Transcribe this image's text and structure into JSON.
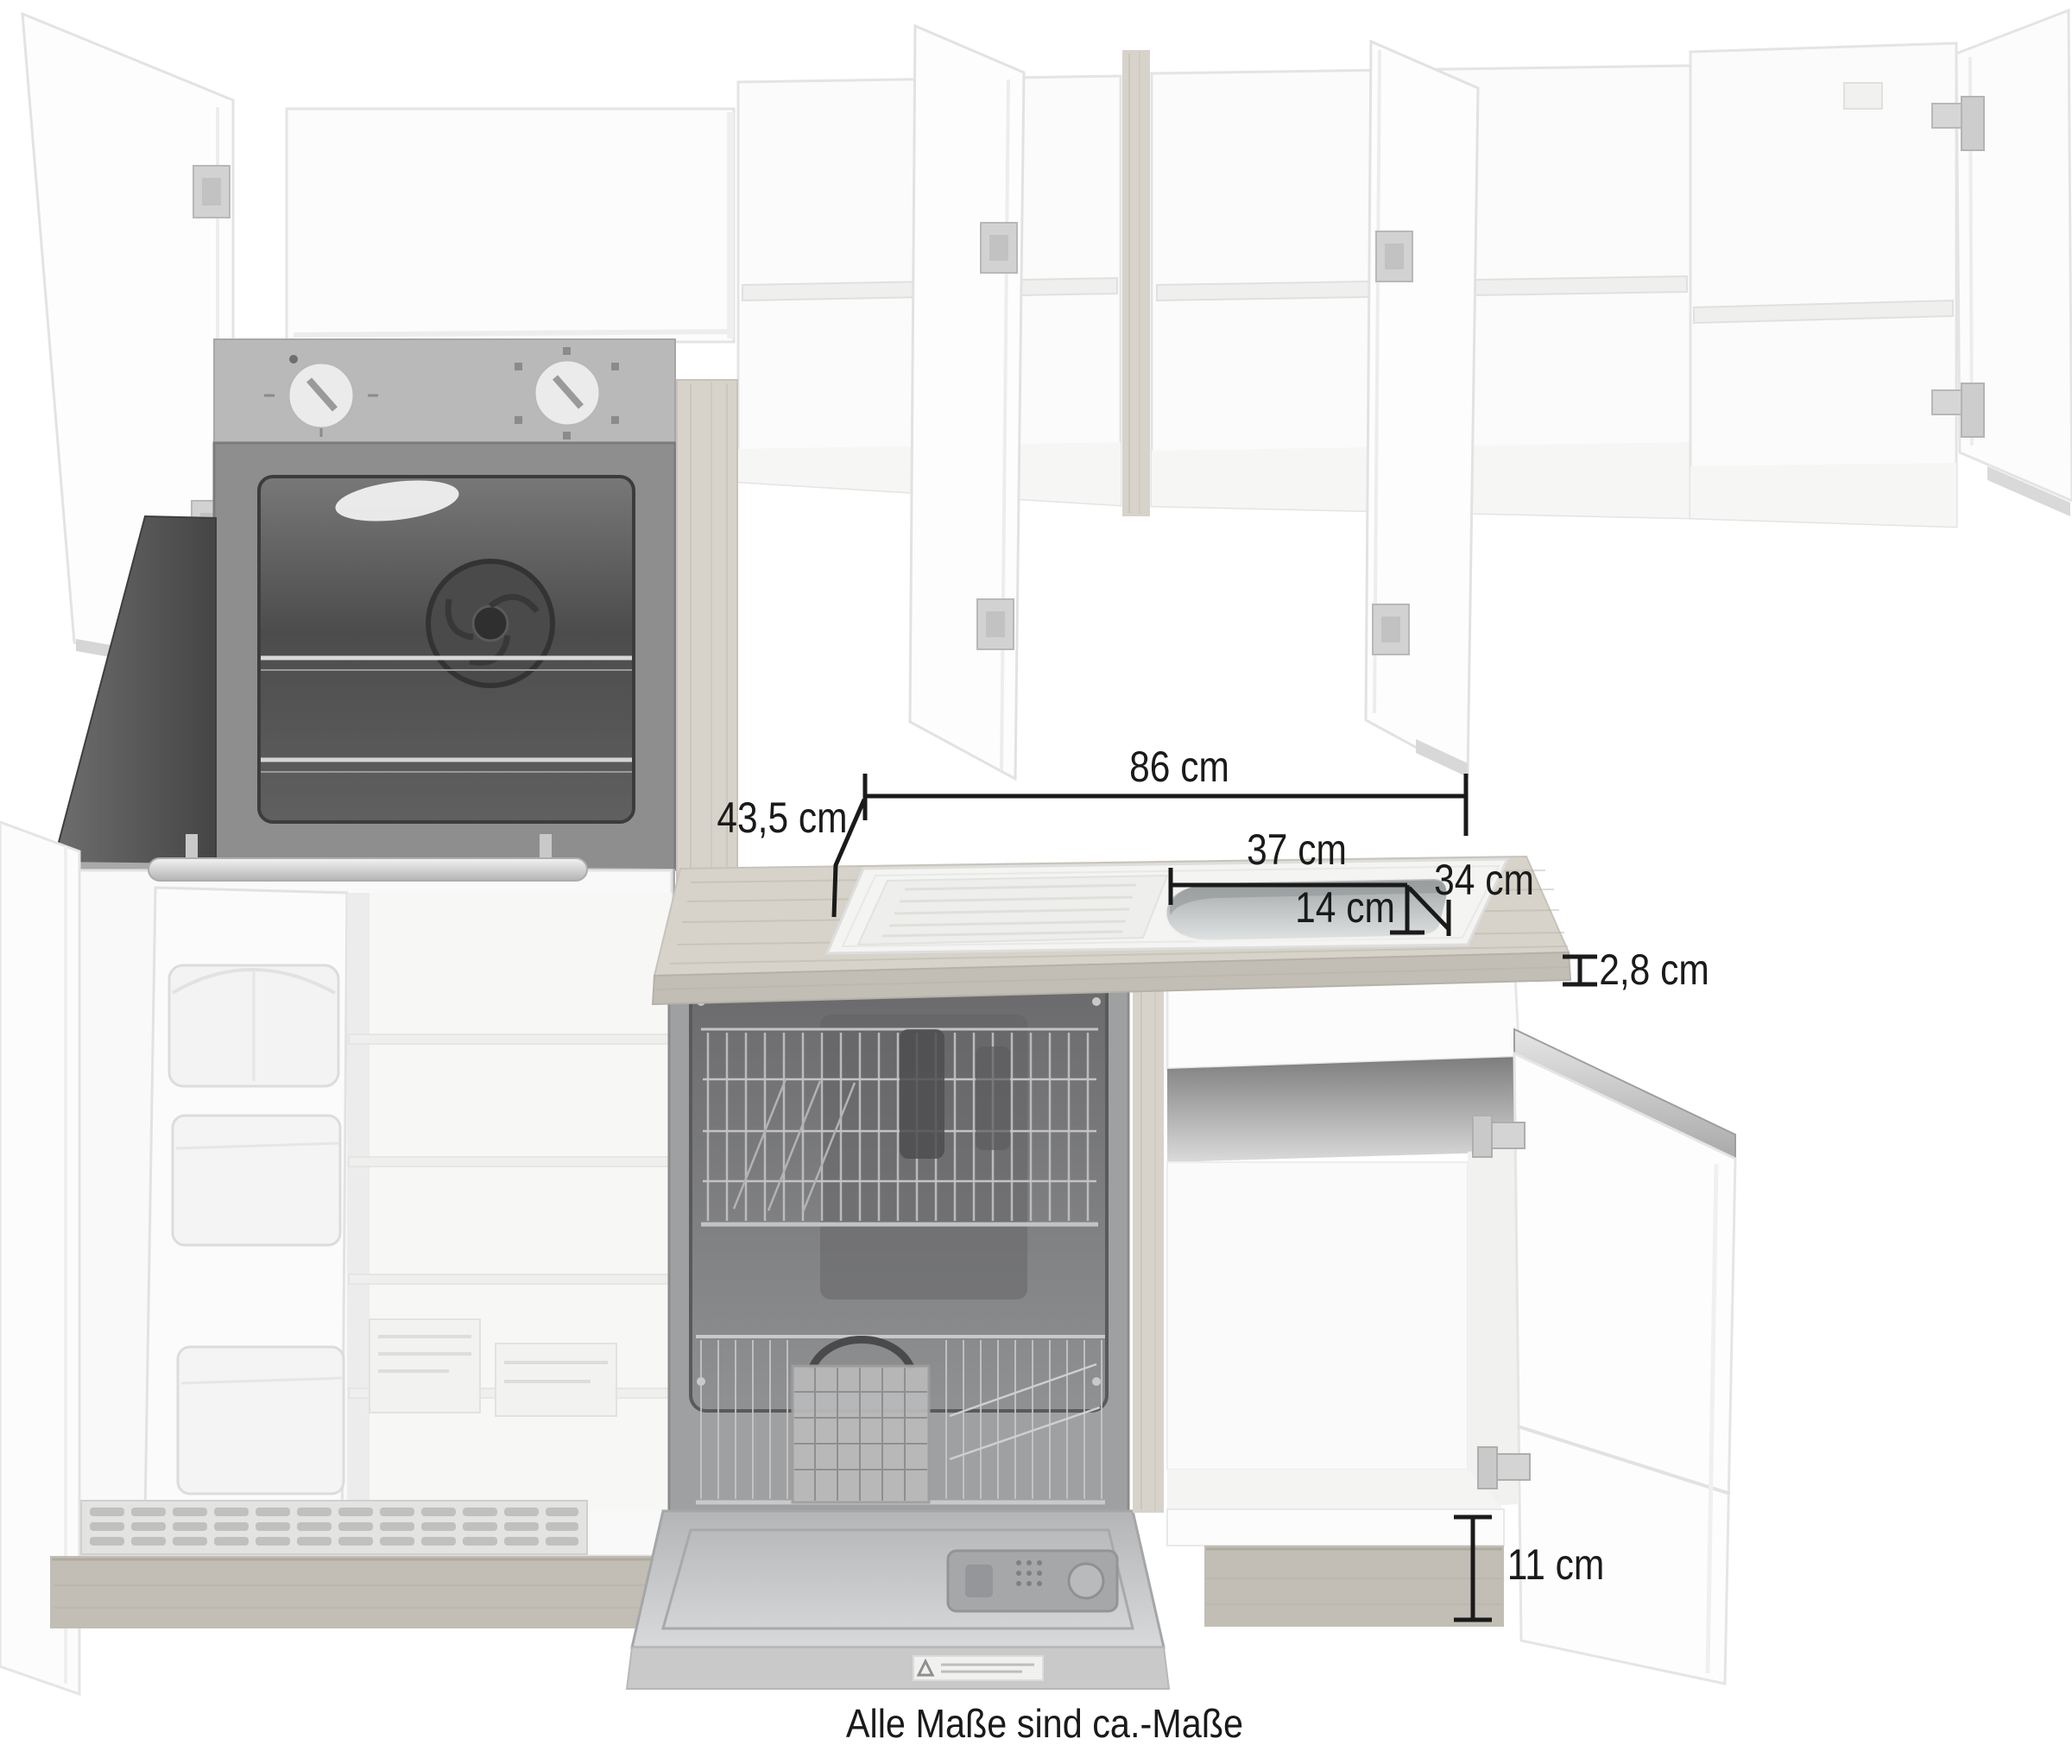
{
  "footer": {
    "note": "Alle Maße sind ca.-Maße"
  },
  "dimensions": {
    "total_width": "86 cm",
    "total_depth": "43,5 cm",
    "sink_length": "37 cm",
    "sink_width": "34 cm",
    "bowl_depth": "14 cm",
    "worktop_thickness": "2,8 cm",
    "plinth_height": "11 cm"
  },
  "colors": {
    "dim": "#1a1a1a",
    "wood": "#d7d3ca",
    "wood-front": "#c2beb5",
    "wood-grain": "#b8b3a8",
    "panel-grey": "#b9b9b9",
    "cavity-dark": "#4c4c4c",
    "steel": "#c7c8c9",
    "outline": "#e4e4e4",
    "white": "#ffffff"
  }
}
